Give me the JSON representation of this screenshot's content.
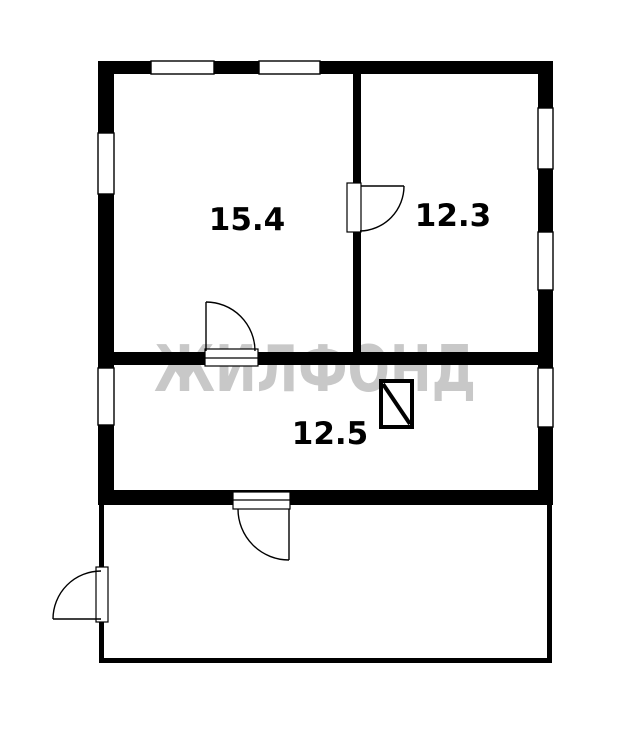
{
  "plan": {
    "type": "floor-plan",
    "watermark": {
      "text": "ЖИЛФОНД",
      "color": "#c8c8c8"
    },
    "rooms": [
      {
        "area_label": "15.4"
      },
      {
        "area_label": "12.3"
      },
      {
        "area_label": "12.5"
      }
    ],
    "symbols": [
      {
        "name": "stove-symbol",
        "description": "rectangle with diagonal line"
      },
      {
        "name": "door-swing",
        "count": 4
      },
      {
        "name": "window",
        "count": 7
      }
    ],
    "colors": {
      "wall": "#000000",
      "floor": "#ffffff",
      "watermark": "#c8c8c8"
    }
  }
}
